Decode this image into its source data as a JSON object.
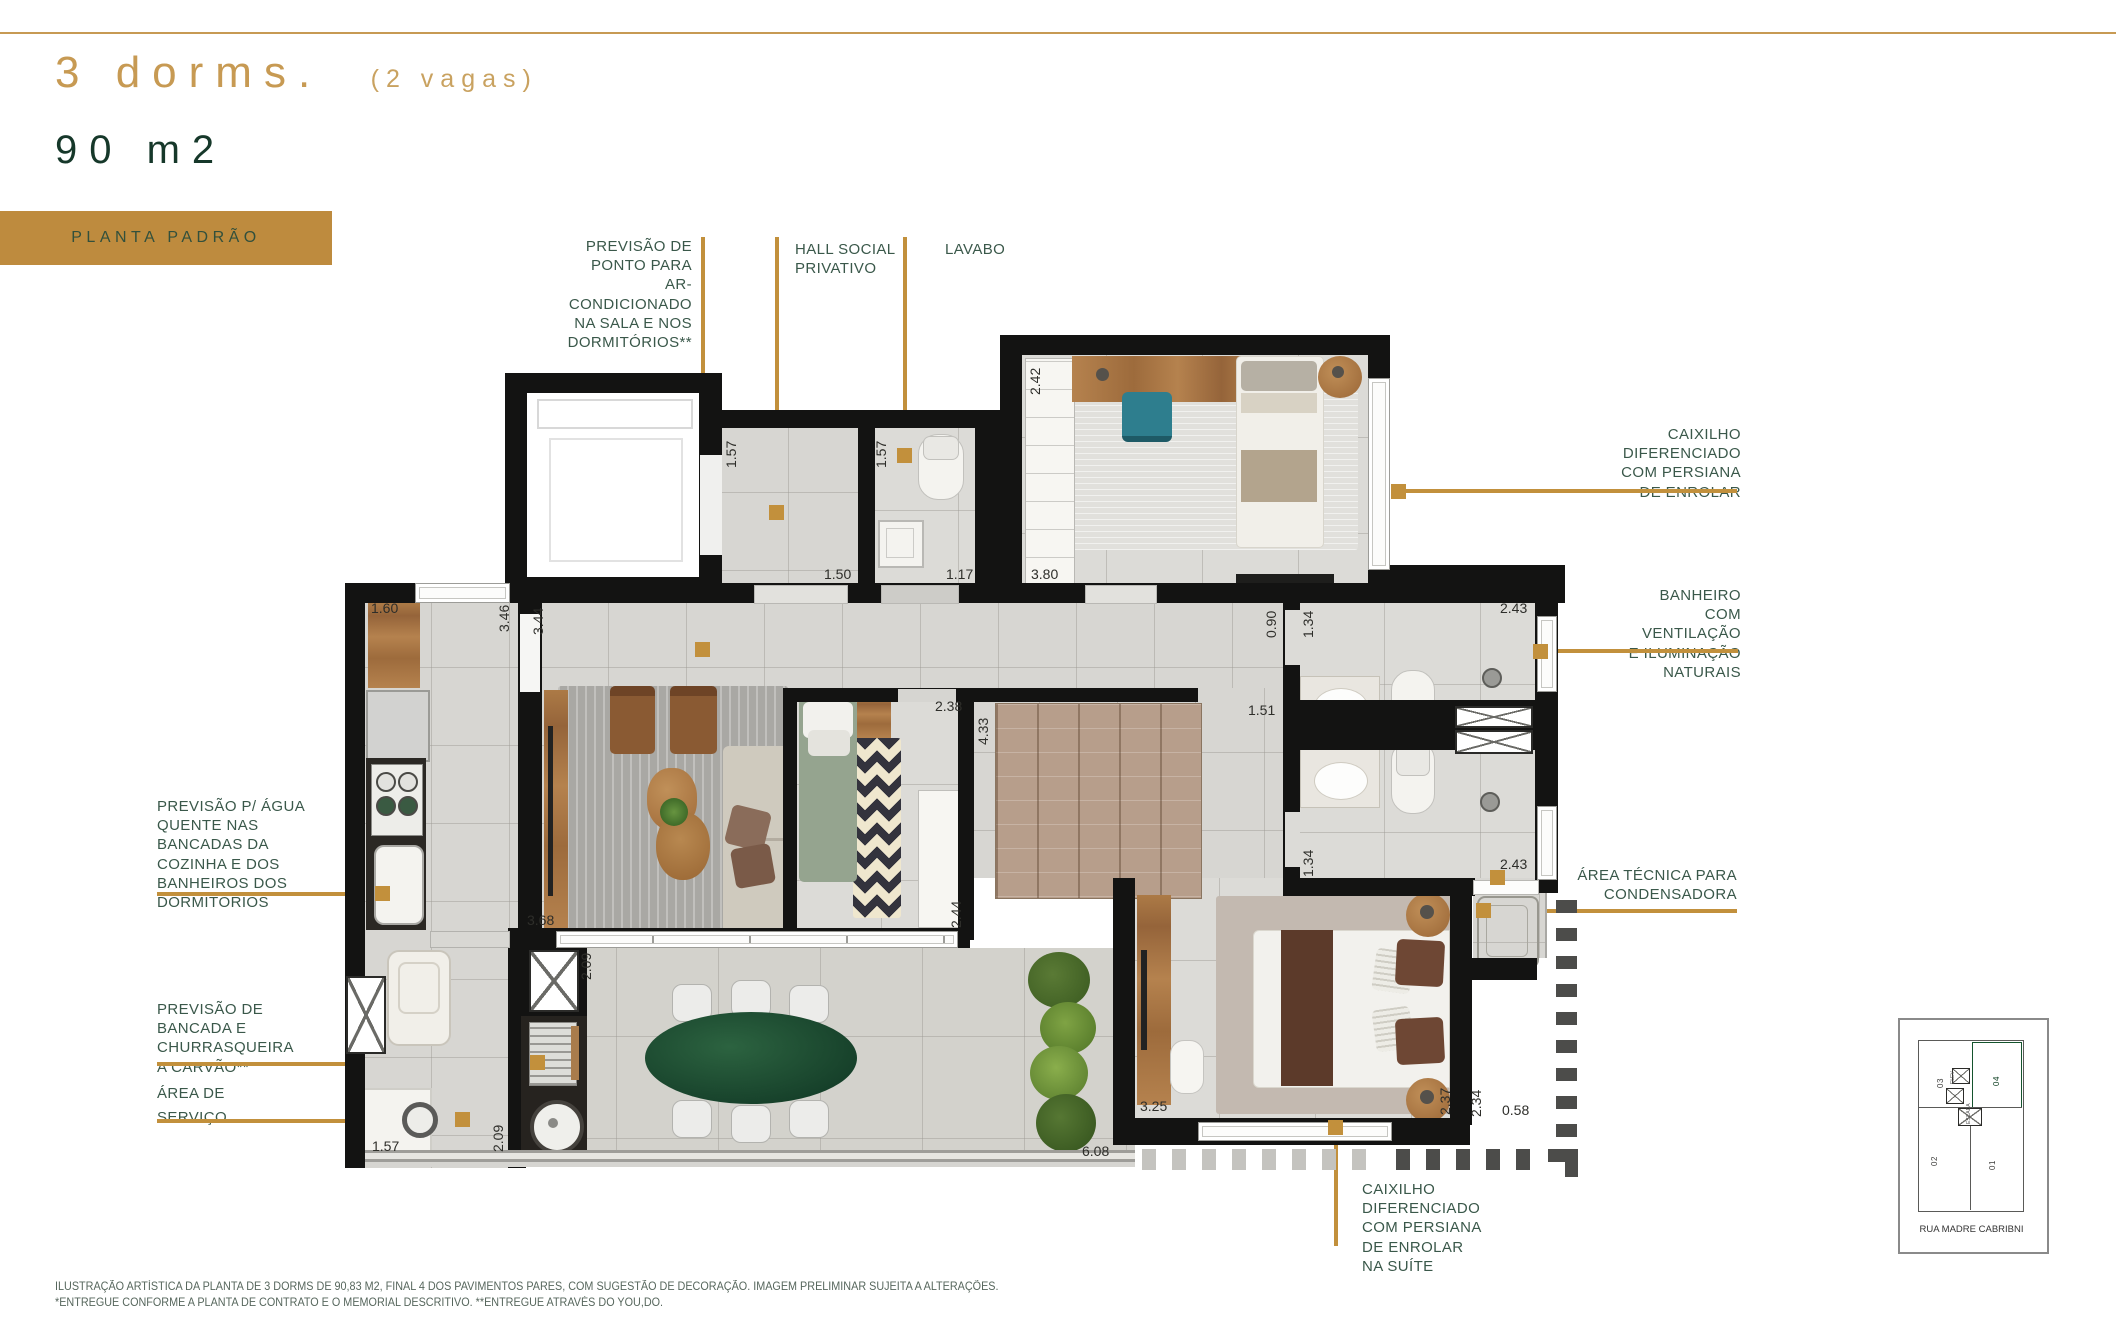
{
  "header": {
    "title": "3 dorms.",
    "title_suffix": "(2 vagas)",
    "subtitle": "90 m2",
    "badge": "PLANTA PADRÃO"
  },
  "callouts": {
    "ac": "PREVISÃO DE\nPONTO PARA\nAR-CONDICIONADO\nNA SALA E NOS\nDORMITÓRIOS**",
    "hall": "HALL SOCIAL\nPRIVATIVO",
    "lavabo": "LAVABO",
    "caixilho": "CAIXILHO\nDIFERENCIADO\nCOM PERSIANA\nDE ENROLAR",
    "banheiro": "BANHEIRO\nCOM VENTILAÇÃO\nE ILUMINAÇÃO\nNATURAIS",
    "area_tecnica": "ÁREA TÉCNICA PARA\nCONDENSADORA",
    "agua_quente": "PREVISÃO P/ ÁGUA\nQUENTE NAS\nBANCADAS DA\nCOZINHA E DOS\nBANHEIROS DOS\nDORMITÓRIOS",
    "churrasqueira": "PREVISÃO DE\nBANCADA E\nCHURRASQUEIRA\nA CARVÃO**",
    "area_servico_1": "ÁREA DE",
    "area_servico_2": "SERVIÇO",
    "caixilho_suite": "CAIXILHO\nDIFERENCIADO\nCOM PERSIANA\nDE ENROLAR\nNA SUÍTE"
  },
  "plan": {
    "dimensions": [
      {
        "t": "1.60",
        "x": 371,
        "y": 600,
        "r": 0
      },
      {
        "t": "3.46",
        "x": 496,
        "y": 632,
        "r": 1
      },
      {
        "t": "3.44",
        "x": 530,
        "y": 635,
        "r": 1
      },
      {
        "t": "1.57",
        "x": 723,
        "y": 468,
        "r": 1
      },
      {
        "t": "1.50",
        "x": 824,
        "y": 566,
        "r": 0
      },
      {
        "t": "1.57",
        "x": 873,
        "y": 468,
        "r": 1
      },
      {
        "t": "1.17",
        "x": 946,
        "y": 566,
        "r": 0
      },
      {
        "t": "2.42",
        "x": 1027,
        "y": 395,
        "r": 1
      },
      {
        "t": "3.80",
        "x": 1031,
        "y": 566,
        "r": 0
      },
      {
        "t": "0.90",
        "x": 1263,
        "y": 638,
        "r": 1
      },
      {
        "t": "1.34",
        "x": 1300,
        "y": 638,
        "r": 1
      },
      {
        "t": "2.43",
        "x": 1500,
        "y": 600,
        "r": 0
      },
      {
        "t": "1.34",
        "x": 1300,
        "y": 877,
        "r": 1
      },
      {
        "t": "2.43",
        "x": 1500,
        "y": 856,
        "r": 0
      },
      {
        "t": "2.38",
        "x": 935,
        "y": 698,
        "r": 0
      },
      {
        "t": "4.33",
        "x": 975,
        "y": 745,
        "r": 1
      },
      {
        "t": "1.51",
        "x": 1248,
        "y": 702,
        "r": 0
      },
      {
        "t": "2.44",
        "x": 948,
        "y": 928,
        "r": 1
      },
      {
        "t": "3.68",
        "x": 527,
        "y": 912,
        "r": 0
      },
      {
        "t": "2.09",
        "x": 578,
        "y": 980,
        "r": 1
      },
      {
        "t": "2.09",
        "x": 490,
        "y": 1152,
        "r": 1
      },
      {
        "t": "1.57",
        "x": 372,
        "y": 1138,
        "r": 0
      },
      {
        "t": "3.25",
        "x": 1140,
        "y": 1098,
        "r": 0
      },
      {
        "t": "2.37",
        "x": 1437,
        "y": 1115,
        "r": 1
      },
      {
        "t": "2.34",
        "x": 1468,
        "y": 1117,
        "r": 1
      },
      {
        "t": "0.58",
        "x": 1502,
        "y": 1102,
        "r": 0
      },
      {
        "t": "6.08",
        "x": 1082,
        "y": 1143,
        "r": 0
      }
    ],
    "markers": [
      {
        "x": 695,
        "y": 642
      },
      {
        "x": 769,
        "y": 505
      },
      {
        "x": 897,
        "y": 448
      },
      {
        "x": 1391,
        "y": 484
      },
      {
        "x": 1533,
        "y": 644
      },
      {
        "x": 1490,
        "y": 870
      },
      {
        "x": 1476,
        "y": 903
      },
      {
        "x": 375,
        "y": 886
      },
      {
        "x": 530,
        "y": 1055
      },
      {
        "x": 455,
        "y": 1112
      },
      {
        "x": 1328,
        "y": 1120
      }
    ]
  },
  "minimap": {
    "street": "RUA MADRE CABRIBNI",
    "unit_01": "01",
    "unit_02": "02",
    "unit_03": "03",
    "unit_04": "04",
    "elev": "ELEV",
    "escada": "ESCADA",
    "highlight_color": "#1F9D44"
  },
  "footer": {
    "line1": "ILUSTRAÇÃO ARTÍSTICA DA PLANTA DE 3 DORMS DE 90,83 M2, FINAL 4 DOS PAVIMENTOS PARES, COM SUGESTÃO DE DECORAÇÃO. IMAGEM PRELIMINAR SUJEITA A ALTERAÇÕES.",
    "line2": "*ENTREGUE CONFORME A PLANTA DE CONTRATO E O MEMORIAL DESCRITIVO. **ENTREGUE ATRAVÉS DO YOU,DO."
  },
  "colors": {
    "accent_gold": "#C2903C",
    "title_gold": "#C79A53",
    "badge_bg": "#BE8B3E",
    "text_green": "#3A584A",
    "dark_green": "#16382A"
  }
}
